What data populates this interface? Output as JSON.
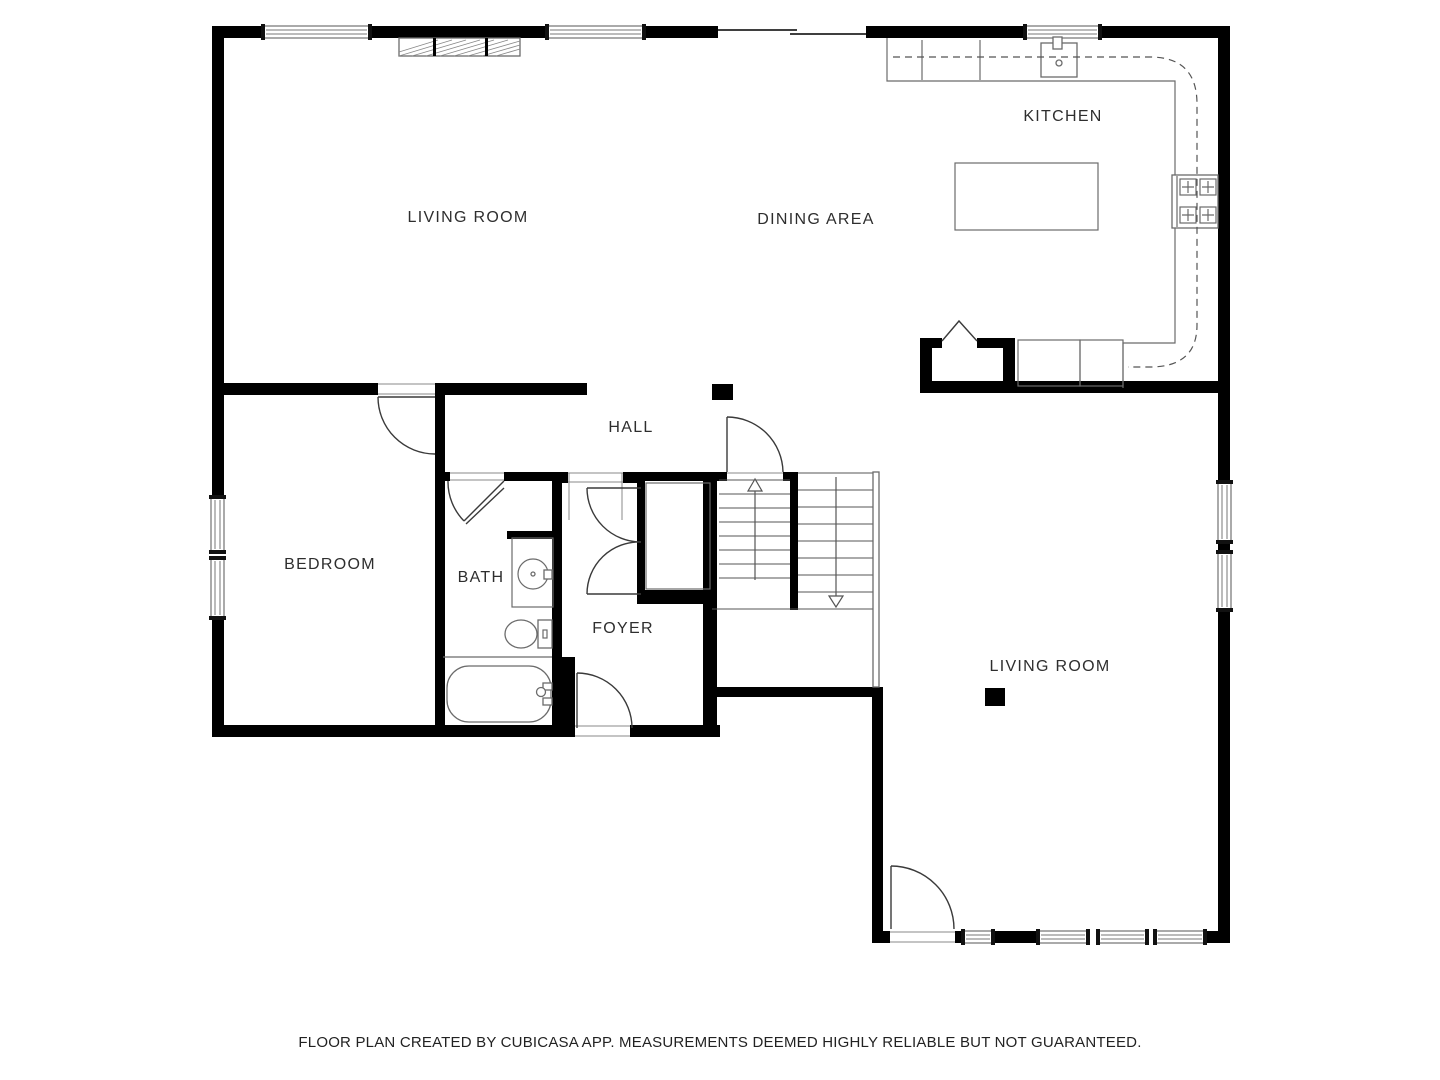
{
  "rooms": {
    "living_room_upper": {
      "label": "LIVING ROOM"
    },
    "dining_area": {
      "label": "DINING AREA"
    },
    "kitchen": {
      "label": "KITCHEN"
    },
    "hall": {
      "label": "HALL"
    },
    "bedroom": {
      "label": "BEDROOM"
    },
    "bath": {
      "label": "BATH"
    },
    "foyer": {
      "label": "FOYER"
    },
    "living_room_lower": {
      "label": "LIVING ROOM"
    }
  },
  "footer": {
    "disclaimer": "FLOOR PLAN CREATED BY CUBICASA APP. MEASUREMENTS DEEMED HIGHLY RELIABLE BUT NOT GUARANTEED."
  },
  "colors": {
    "wall": "#000000",
    "fixture_line": "#6b6b6b",
    "door_arc": "#3a3a3a",
    "label_text": "#2e2e2e",
    "background": "#ffffff"
  },
  "fixtures": [
    "kitchen-sink-icon",
    "stove-icon",
    "kitchen-island",
    "pantry-fold-door",
    "fireplace-icon",
    "bath-vanity-sink-icon",
    "toilet-icon",
    "bathtub-icon",
    "stairs-up-arrow",
    "stairs-down-arrow"
  ]
}
